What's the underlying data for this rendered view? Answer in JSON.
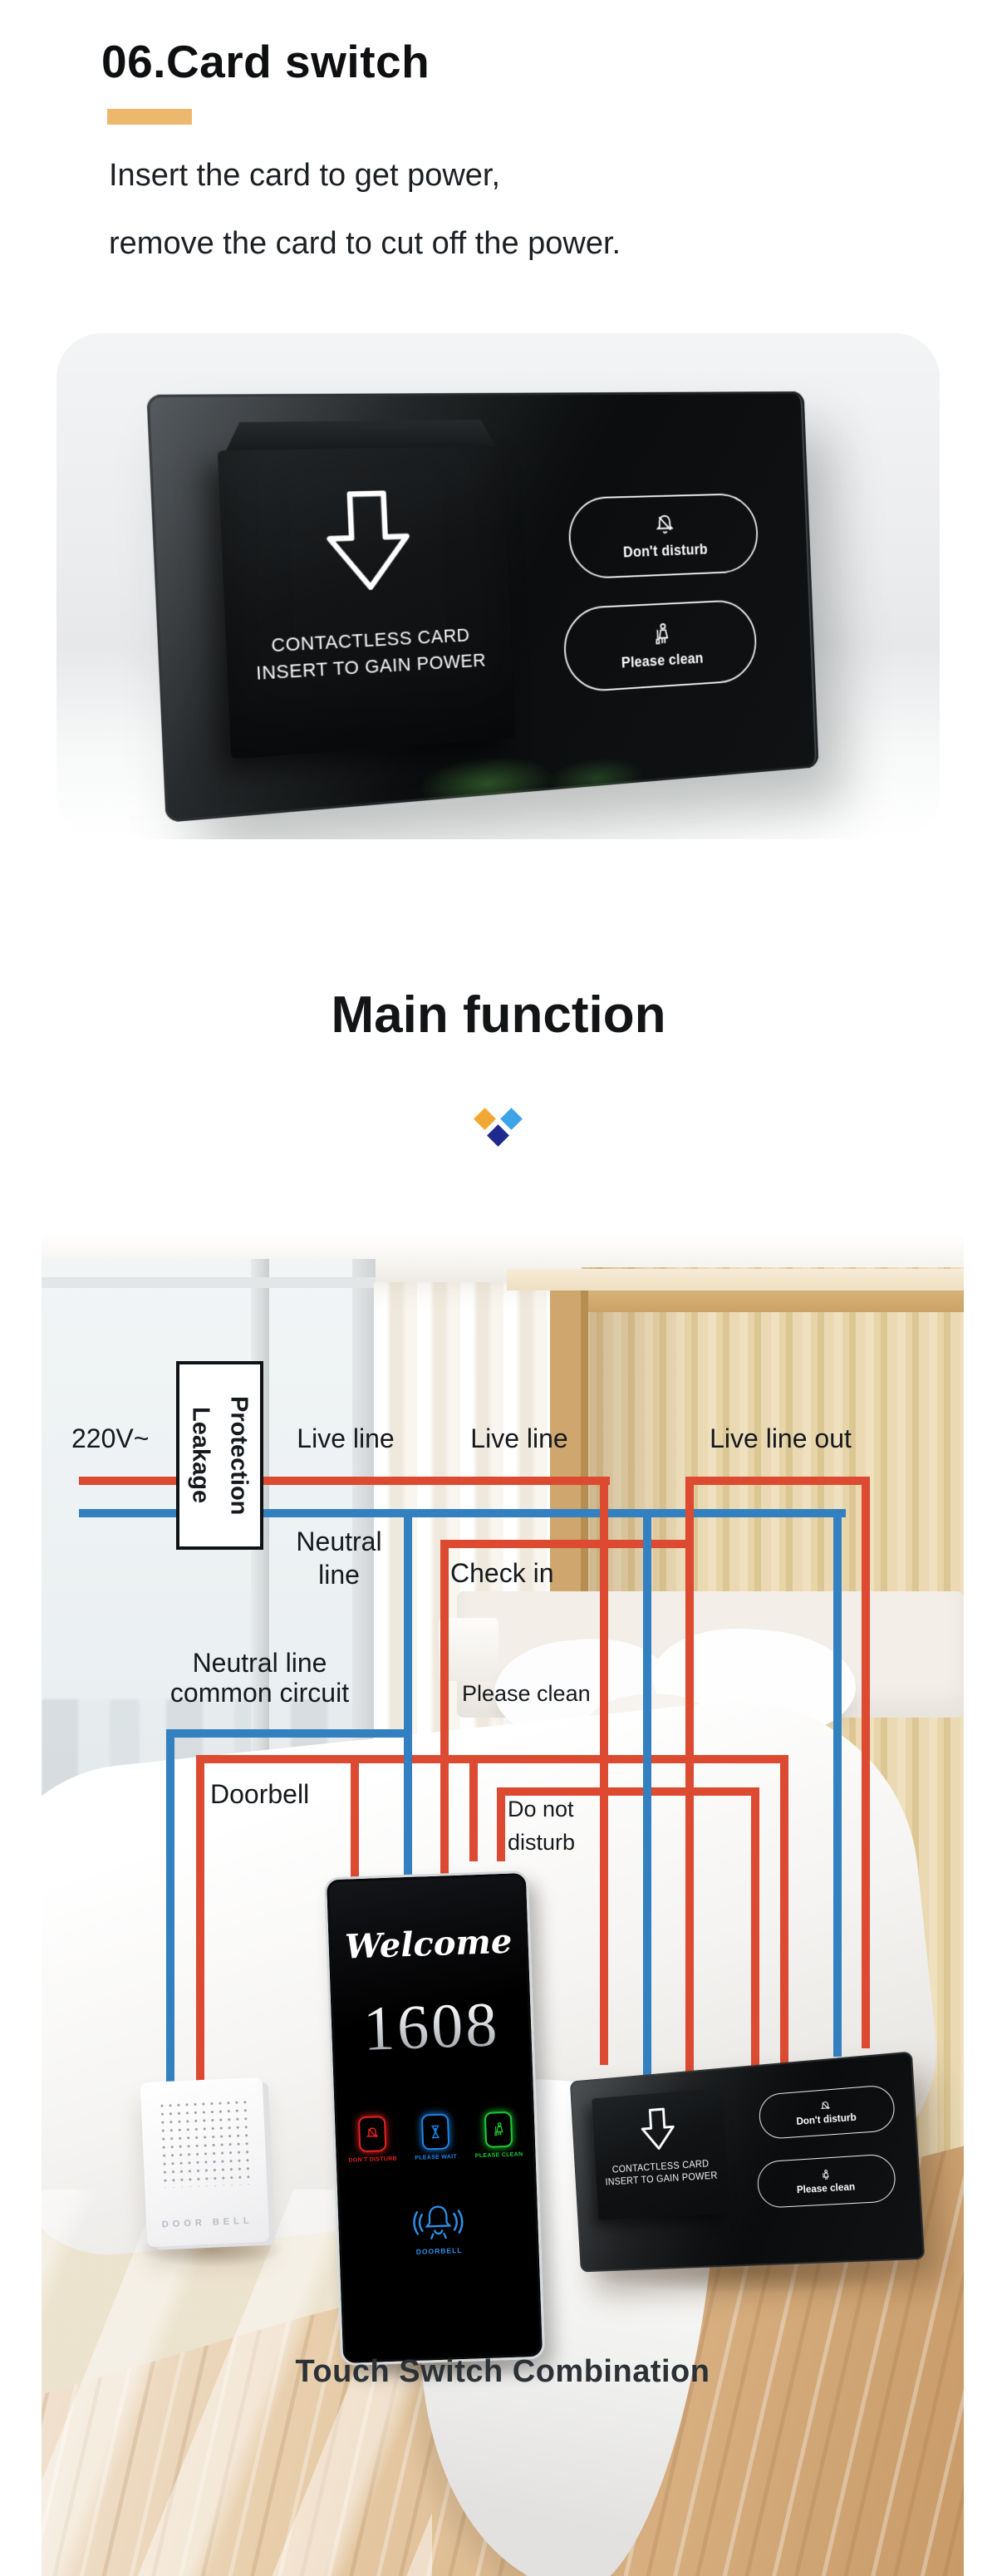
{
  "colors": {
    "accent": "#ECB86D",
    "live": "#DC4A31",
    "neutral": "#3380C1",
    "diamond-orange": "#F1A733",
    "diamond-blue": "#3EA3E9",
    "diamond-navy": "#202A8C",
    "tp-red": "#E62222",
    "tp-blue": "#1E84E8",
    "tp-green": "#1DCB35",
    "tp-doorbell": "#2E8FE8",
    "caption": "#2C3136"
  },
  "intro": {
    "heading": "06.Card switch",
    "line1": "Insert the card to get power,",
    "line2": "remove the card to cut off the power."
  },
  "product": {
    "slot_line1": "CONTACTLESS CARD",
    "slot_line2": "INSERT TO GAIN POWER",
    "dnd": "Don't disturb",
    "clean": "Please clean"
  },
  "main_function": {
    "heading": "Main function"
  },
  "diagram": {
    "voltage": "220V~",
    "leakage_1": "Leakage",
    "leakage_2": "Protection",
    "live_1": "Live line",
    "live_2": "Live line",
    "live_out": "Live line out",
    "neutral_1a": "Neutral",
    "neutral_1b": "line",
    "check_in": "Check in",
    "neutral_2a": "Neutral line",
    "neutral_2b": "common circuit",
    "please_clean": "Please clean",
    "doorbell": "Doorbell",
    "dnd_1": "Do not",
    "dnd_2": "disturb",
    "caption": "Touch Switch Combination"
  },
  "touch_panel": {
    "welcome": "Welcome",
    "room": "1608",
    "icons": [
      {
        "label": "DON'T DISTURB"
      },
      {
        "label": "PLEASE WAIT"
      },
      {
        "label": "PLEASE CLEAN"
      }
    ],
    "doorbell_label": "DOORBELL"
  },
  "doorbell_device": {
    "label": "DOOR BELL"
  },
  "wall_panel": {
    "slot_line1": "CONTACTLESS CARD",
    "slot_line2": "INSERT TO GAIN POWER",
    "dnd": "Don't disturb",
    "clean": "Please clean"
  }
}
